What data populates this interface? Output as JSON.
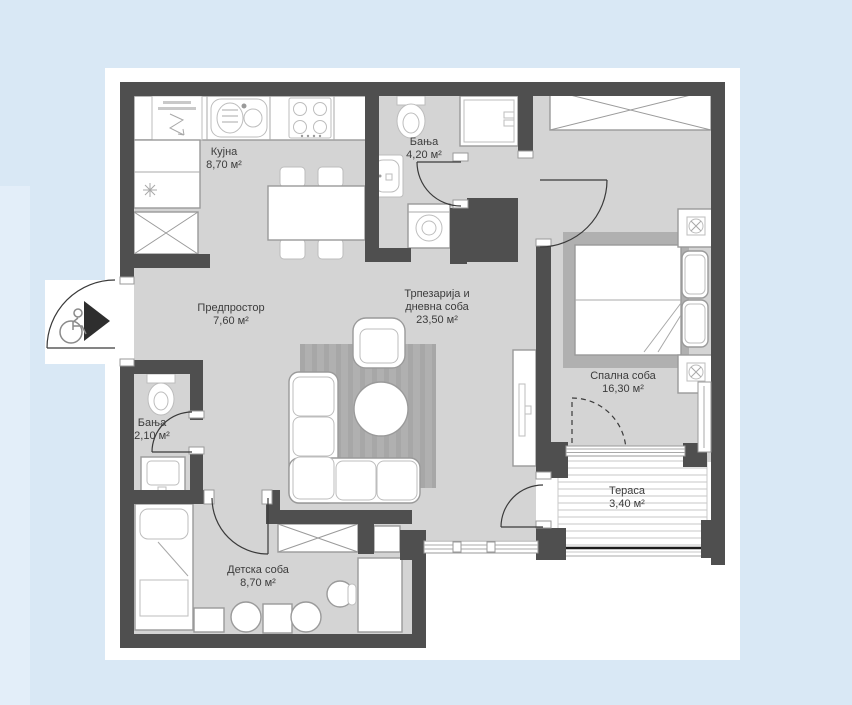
{
  "page": {
    "background": "#d9e8f5",
    "left_panel": "#e3eef9",
    "sheet": "#ffffff"
  },
  "colors": {
    "wall": "#4f4f4f",
    "floor": "#d4d4d4",
    "rug": "#b0b0b0",
    "stroke": "#9a9a9a",
    "door": "#3a3a3a",
    "text": "#3c3c3c",
    "arrow": "#2e2e2e"
  },
  "rooms": [
    {
      "id": "kitchen",
      "name": "Кујна",
      "area": "8,70 м²"
    },
    {
      "id": "bathroom_large",
      "name": "Бања",
      "area": "4,20 м²"
    },
    {
      "id": "hallway",
      "name": "Предпростор",
      "area": "7,60 м²"
    },
    {
      "id": "living_dining",
      "name": "Трпезарија и дневна соба",
      "area": "23,50 м²"
    },
    {
      "id": "bedroom",
      "name": "Спална соба",
      "area": "16,30 м²"
    },
    {
      "id": "bathroom_small",
      "name": "Бања",
      "area": "2,10 м²"
    },
    {
      "id": "kids_room",
      "name": "Детска соба",
      "area": "8,70 м²"
    },
    {
      "id": "terrace",
      "name": "Тераса",
      "area": "3,40 м²"
    }
  ],
  "icons": {
    "entrance_arrow": "filled-triangle-right",
    "wheelchair": "wheelchair-outline",
    "kitchen_light": "asterisk",
    "electrical_feed": "zigzag-arrow",
    "bedside_lamp": "circle-cross",
    "wardrobe": "x-cross-box"
  }
}
